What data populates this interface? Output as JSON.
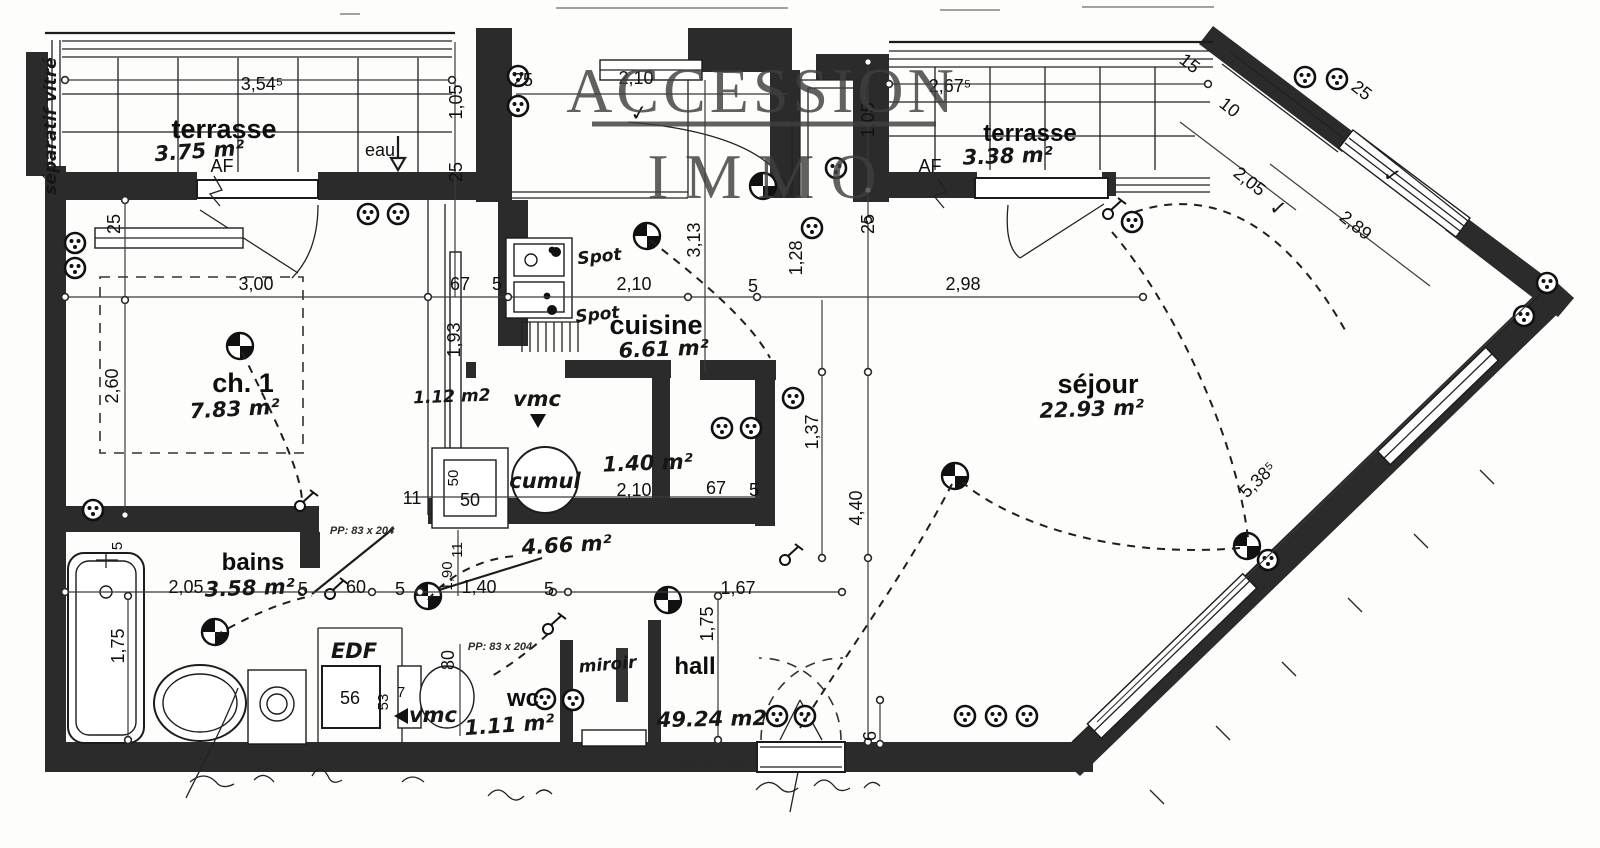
{
  "watermark": {
    "line1": "ACCESSION",
    "line2": "IMMO"
  },
  "rooms": {
    "terrasse_left": {
      "name": "terrasse",
      "area": "3.75 m²"
    },
    "terrasse_right": {
      "name": "terrasse",
      "area": "3.38 m²"
    },
    "ch1": {
      "name": "ch. 1",
      "area": "7.83 m²"
    },
    "cuisine": {
      "name": "cuisine",
      "area": "6.61 m²"
    },
    "sejour": {
      "name": "séjour",
      "area": "22.93 m²"
    },
    "bains": {
      "name": "bains",
      "area": "3.58 m²"
    },
    "wc": {
      "name": "wc",
      "area": "1.11 m²"
    },
    "hall": {
      "name": "hall",
      "area": "49.24 m2"
    },
    "degagement": {
      "area": "4.66 m²"
    },
    "cellier": {
      "area": "1.40 m²"
    },
    "placard": {
      "area": "1.12 m2"
    }
  },
  "annotations": {
    "af": "AF",
    "eau": "eau",
    "separatif": "séparatif vitré",
    "edf": "EDF",
    "vmc": "vmc",
    "cumul": "cumul",
    "spot": "Spot",
    "miroir": "miroir",
    "pp83": "PP: 83 x 204",
    "pp93": "PP: 93 x 204",
    "check": "✓"
  },
  "dims": {
    "t354": "3,54⁵",
    "t25": "25",
    "t210": "2,10",
    "t2675": "2,67⁵",
    "l105": "1,05",
    "l25": "25",
    "r105": "1,05",
    "r25": "25",
    "d15": "15",
    "d25": "25",
    "d10": "10",
    "d205": "2,05",
    "d289": "2,89",
    "d5385": "5,38⁵",
    "ch25": "25",
    "ch300": "3,00",
    "ch260": "2,60",
    "m67": "67",
    "m5": "5",
    "m193": "1,93",
    "k210": "2,10",
    "k5": "5",
    "k313": "3,13",
    "s128": "1,28",
    "s298": "2,98",
    "s137": "1,37",
    "s440": "4,40",
    "s6": "6",
    "low210": "2,10",
    "low67": "67",
    "low5": "5",
    "g11a": "11",
    "g50a": "50",
    "g50b": "50",
    "g11b": "11",
    "b205": "2,05",
    "b5a": "5",
    "b60": "60",
    "b5b": "5",
    "b5t": "5",
    "b175": "1,75",
    "c140": "1,40",
    "c5": "5",
    "c167": "1,67",
    "w190": "1,90",
    "w80": "80",
    "h175": "1,75",
    "e56": "56",
    "e53": "53",
    "e7": "7"
  }
}
